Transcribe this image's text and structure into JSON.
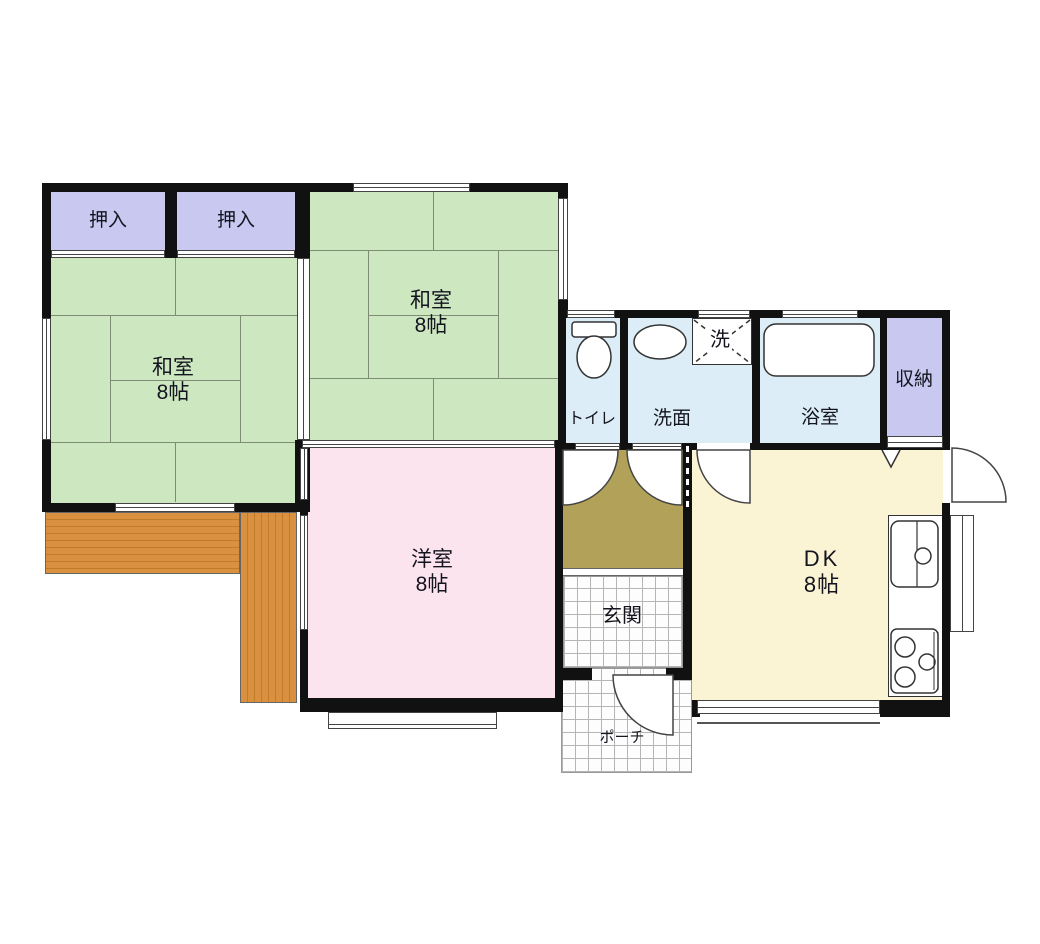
{
  "rooms": {
    "closet_left": {
      "label": "押入"
    },
    "closet_right": {
      "label": "押入"
    },
    "washitsu_left": {
      "name": "和室",
      "size": "8帖"
    },
    "washitsu_top": {
      "name": "和室",
      "size": "8帖"
    },
    "western": {
      "name": "洋室",
      "size": "8帖"
    },
    "toilet": {
      "label": "トイレ"
    },
    "washroom": {
      "label": "洗面"
    },
    "laundry": {
      "label": "洗"
    },
    "bath": {
      "label": "浴室"
    },
    "storage": {
      "label": "収納"
    },
    "dk": {
      "name": "DK",
      "size": "8帖"
    },
    "entrance": {
      "label": "玄関"
    },
    "porch": {
      "label": "ポーチ"
    }
  },
  "colors": {
    "tatami": "#cde7c0",
    "closet": "#c8c8f1",
    "western_room": "#fce4ee",
    "wet_area": "#dcedf7",
    "dining_kitchen": "#faf4d4",
    "hallway": "#b1a159",
    "deck": "#d9913f",
    "wall": "#111111",
    "tile_line": "#b5b5b5"
  }
}
